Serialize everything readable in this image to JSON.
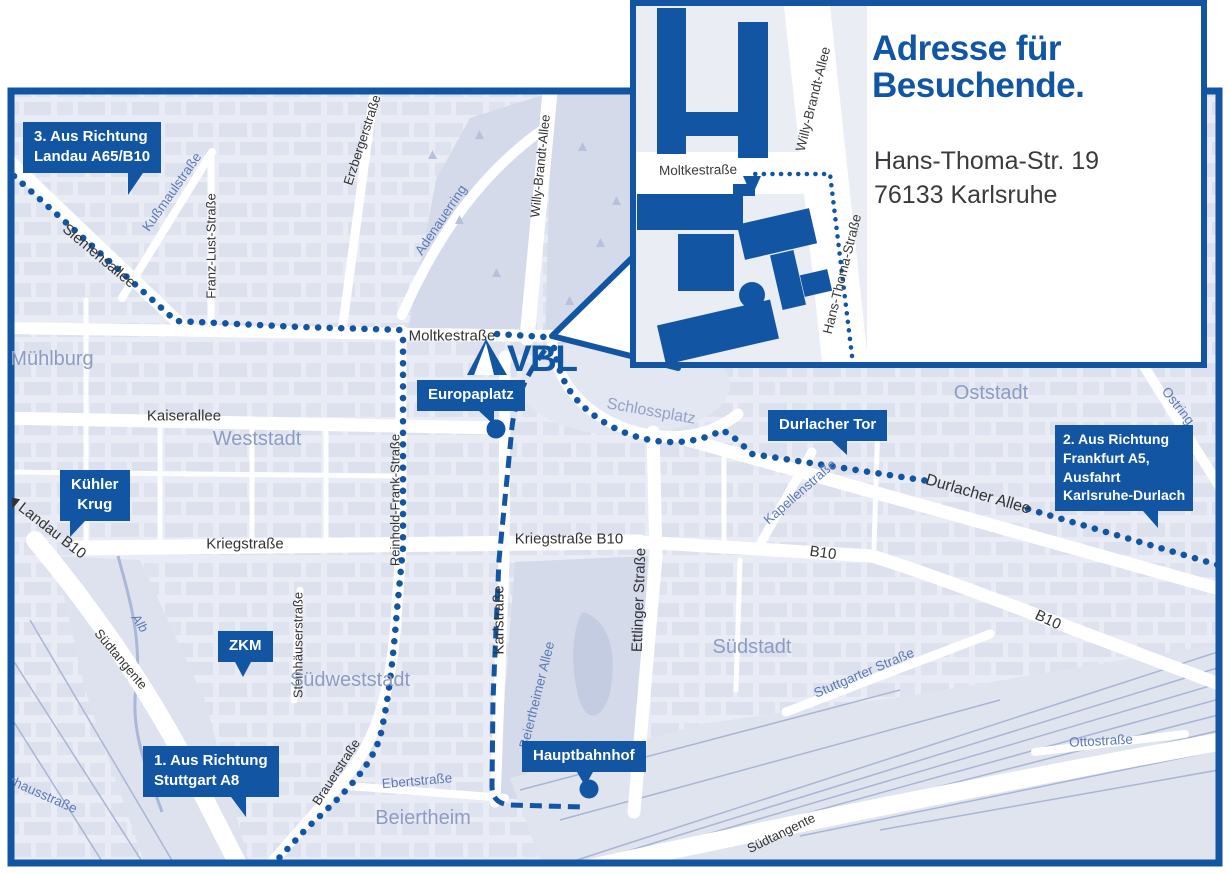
{
  "colors": {
    "accent_blue": "#1256a3",
    "map_background": "#e9ecf4",
    "block_fill": "#d2d8e8",
    "park_fill": "#d4dae9",
    "street_white": "#ffffff",
    "street_label_dark": "#333333",
    "street_label_blue": "#5d79b5",
    "area_label": "#8d9cc5",
    "inset_text": "#3b3b3b"
  },
  "logo": {
    "text": "VBL"
  },
  "inset": {
    "title": "Adresse für\nBesuchende.",
    "address": "Hans-Thoma-Str. 19\n76133 Karlsruhe",
    "street_labels": [
      {
        "text": "Moltkestraße"
      },
      {
        "text": "Willy-Brandt-Allee"
      },
      {
        "text": "Hans-Thoma-Straße"
      }
    ]
  },
  "callouts": [
    {
      "id": "route-3",
      "text": "3. Aus Richtung\nLandau A65/B10"
    },
    {
      "id": "kuehler-krug",
      "text": "Kühler\nKrug"
    },
    {
      "id": "zkm",
      "text": "ZKM"
    },
    {
      "id": "route-1",
      "text": "1. Aus Richtung\nStuttgart A8"
    },
    {
      "id": "europaplatz",
      "text": "Europaplatz"
    },
    {
      "id": "hauptbahnhof",
      "text": "Hauptbahnhof"
    },
    {
      "id": "durlacher-tor",
      "text": "Durlacher Tor"
    },
    {
      "id": "route-2",
      "text": "2. Aus Richtung\nFrankfurt A5,\nAusfahrt\nKarlsruhe-Durlach"
    }
  ],
  "street_labels": [
    {
      "text": "Siemensallee"
    },
    {
      "text": "Moltkestraße"
    },
    {
      "text": "Kaiserallee"
    },
    {
      "text": "Kriegstraße"
    },
    {
      "text": "Kriegstraße B10"
    },
    {
      "text": "B10"
    },
    {
      "text": "B10"
    },
    {
      "text": "Karlstraße"
    },
    {
      "text": "Ettlinger Straße"
    },
    {
      "text": "Reinhold-Frank-Straße"
    },
    {
      "text": "Willy-Brandt-Allee"
    },
    {
      "text": "Durlacher Allee"
    },
    {
      "text": "◀ Landau B10"
    },
    {
      "text": "Franz-Lust-Straße"
    },
    {
      "text": "Erzbergerstraße"
    },
    {
      "text": "Kußmaulstraße"
    },
    {
      "text": "Adenauerring"
    },
    {
      "text": "Kapellenstraße"
    },
    {
      "text": "Steinhäuserstraße"
    },
    {
      "text": "Brauerstraße"
    },
    {
      "text": "Südtangente"
    },
    {
      "text": "Südtangente"
    },
    {
      "text": "Ebertstraße"
    },
    {
      "text": "Stuttgarter Straße"
    },
    {
      "text": "Ottostraße"
    },
    {
      "text": "Ostring"
    },
    {
      "text": "Alb"
    },
    {
      "text": "Pulverhausstraße"
    },
    {
      "text": "Beiertheimer Allee"
    }
  ],
  "area_labels": [
    {
      "text": "Mühlburg"
    },
    {
      "text": "Weststadt"
    },
    {
      "text": "Oststadt"
    },
    {
      "text": "Südstadt"
    },
    {
      "text": "Südweststadt"
    },
    {
      "text": "Beiertheim"
    },
    {
      "text": "Schlossplatz"
    }
  ]
}
